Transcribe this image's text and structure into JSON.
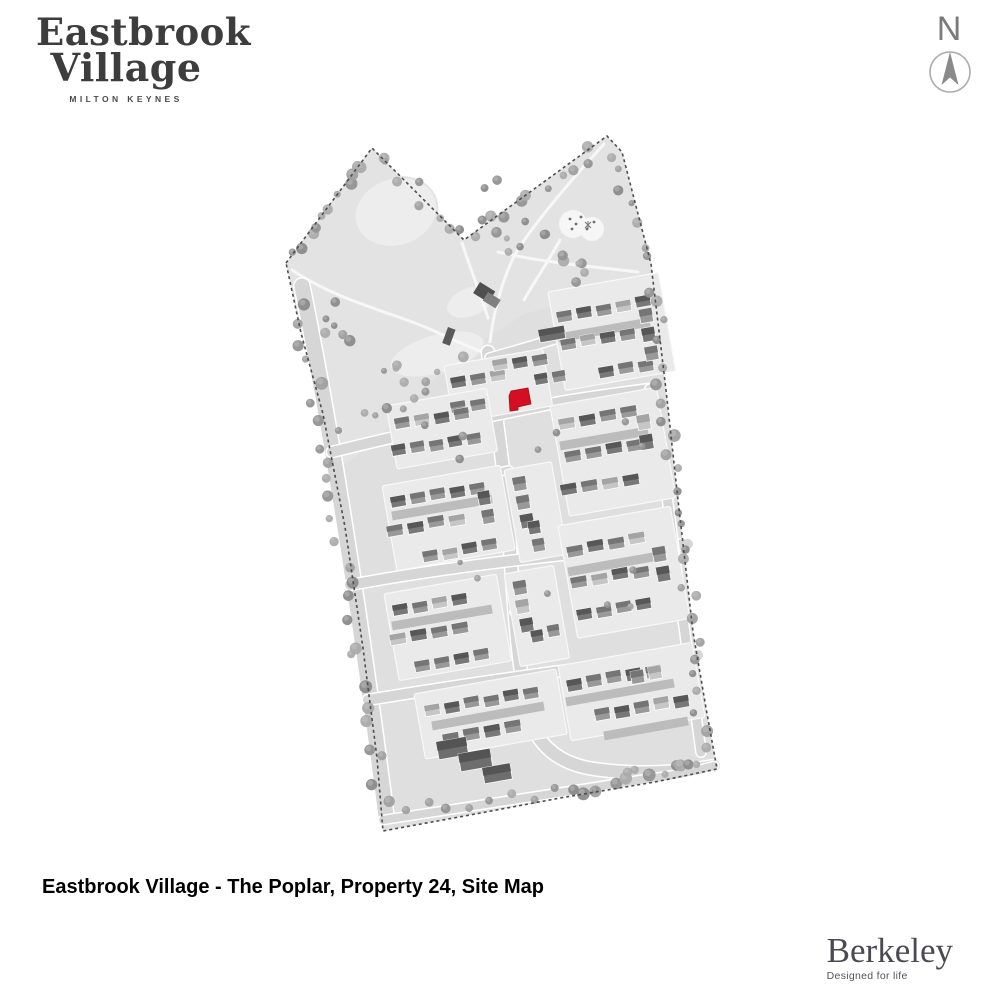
{
  "page": {
    "width": 1000,
    "height": 1000,
    "background": "#ffffff"
  },
  "header": {
    "logo": {
      "line1": "Eastbrook",
      "line2": "Village",
      "subtitle": "MILTON KEYNES",
      "color": "#3d3d3d"
    }
  },
  "compass": {
    "label": "N"
  },
  "caption": {
    "text": "Eastbrook Village - The Poplar, Property 24, Site Map"
  },
  "footer": {
    "brand": "Berkeley",
    "tagline": "Designed for life",
    "color": "#4a4a52"
  },
  "map": {
    "colors": {
      "base": "#dfdfdf",
      "park": "#e3e3e3",
      "pond": "#ededed",
      "pond_edge": "#e3e3e3",
      "path": "#f7f7f7",
      "road": "#d6d6d6",
      "road_casing": "#ffffff",
      "parcel": "#eaeaea",
      "parcel_edge": "#f8f8f8",
      "drive": "#bcbcbc",
      "boundary": "#4d4d4d",
      "highlight": "#d30f23",
      "highlight_edge": "#a50d1a",
      "tree_palette": [
        "#a0a0a0",
        "#949494",
        "#ababab",
        "#8b8b8b"
      ],
      "house": {
        "mid": [
          "#999999",
          "#757575"
        ],
        "dark": [
          "#787878",
          "#575757"
        ],
        "light": [
          "#c6c6c6",
          "#a4a4a4"
        ]
      },
      "apartment": [
        "#6e6e6e",
        "#545454"
      ]
    },
    "boundary": "286,263 372,148 464,240 607,136 622,152 651,264 666,390 678,500 693,632 706,708 717,769 655,782 560,798 470,815 383,831 377,758 363,648 345,527 323,414 301,333",
    "park": "286,263 372,148 464,240 607,136 622,152 651,264 643,300 584,298 524,314 490,336 464,352 434,380 402,414 372,444 338,470 327,436 301,333",
    "ponds": [
      {
        "cx": 396,
        "cy": 212,
        "rx": 42,
        "ry": 34,
        "rot": -18
      },
      {
        "cx": 470,
        "cy": 302,
        "rx": 25,
        "ry": 15,
        "rot": -22
      },
      {
        "cx": 437,
        "cy": 354,
        "rx": 49,
        "ry": 20,
        "rot": -16
      }
    ],
    "paths": [
      "M292,270 C340,302 392,312 432,330 C462,344 476,350 488,354",
      "M604,144 C566,186 544,212 520,246 C506,268 494,306 490,342",
      "M462,243 C470,268 480,292 488,318",
      "M498,252 C540,262 586,266 638,272",
      "M560,240 C548,262 534,282 524,300"
    ],
    "roads": [
      {
        "d": "M302,286 C330,424 360,612 386,816",
        "w": 15
      },
      {
        "d": "M488,352 C496,420 505,472 509,532 C513,594 516,652 527,708 C534,744 558,766 602,770 C642,775 682,772 714,766",
        "w": 12
      },
      {
        "d": "M332,452 C420,430 500,414 560,402 C602,395 628,392 650,389",
        "w": 10
      },
      {
        "d": "M350,585 C430,570 520,559 600,551 C632,548 662,546 688,544",
        "w": 10
      },
      {
        "d": "M368,700 C440,688 520,676 600,666 C642,661 672,658 698,655",
        "w": 10
      },
      {
        "d": "M650,389 C662,450 670,520 678,582 C686,642 694,702 701,752",
        "w": 9
      },
      {
        "d": "M490,358 C540,344 578,332 616,320 C636,314 648,308 650,296",
        "w": 9
      },
      {
        "d": "M383,820 C470,807 560,792 640,780 C672,776 696,771 714,766",
        "w": 8
      },
      {
        "d": "M509,470 L478,476",
        "w": 7
      },
      {
        "d": "M514,612 L556,606",
        "w": 7
      }
    ],
    "driveways": [
      "M558,338 l92,-16",
      "M560,446 l88,-15",
      "M392,516 l100,-17",
      "M568,572 l96,-17",
      "M392,626 l100,-17",
      "M566,702 l108,-19",
      "M432,726 l112,-20",
      "M604,736 l84,-15"
    ],
    "clusters": [
      {
        "parcel": [
          548,
          292,
          112,
          100
        ],
        "rows": [
          {
            "x": 556,
            "y": 312,
            "n": 5
          },
          {
            "x": 560,
            "y": 340,
            "n": 4
          },
          {
            "x": 598,
            "y": 368,
            "n": 3
          },
          {
            "x": 638,
            "y": 310,
            "n": 3,
            "dir": "v",
            "w": 13,
            "h": 14
          }
        ]
      },
      {
        "parcel": [
          444,
          366,
          100,
          58
        ],
        "rows": [
          {
            "x": 450,
            "y": 378,
            "n": 3
          },
          {
            "x": 492,
            "y": 362,
            "n": 3
          },
          {
            "x": 450,
            "y": 404,
            "n": 2
          },
          {
            "x": 534,
            "y": 376,
            "n": 2,
            "w": 13,
            "h": 11
          }
        ]
      },
      {
        "parcel": [
          386,
          406,
          102,
          64
        ],
        "rows": [
          {
            "x": 394,
            "y": 420,
            "n": 4
          },
          {
            "x": 391,
            "y": 447,
            "n": 5,
            "w": 14
          }
        ]
      },
      {
        "parcel": [
          550,
          406,
          108,
          112
        ],
        "rows": [
          {
            "x": 558,
            "y": 420,
            "n": 4,
            "w": 16
          },
          {
            "x": 564,
            "y": 452,
            "n": 4,
            "w": 16
          },
          {
            "x": 560,
            "y": 486,
            "n": 4,
            "w": 16
          },
          {
            "x": 636,
            "y": 416,
            "n": 2,
            "dir": "v",
            "w": 13,
            "h": 15
          }
        ]
      },
      {
        "parcel": [
          382,
          486,
          120,
          86
        ],
        "rows": [
          {
            "x": 390,
            "y": 498,
            "n": 5
          },
          {
            "x": 386,
            "y": 526,
            "n": 4,
            "w": 16
          },
          {
            "x": 422,
            "y": 552,
            "n": 4
          },
          {
            "x": 478,
            "y": 492,
            "n": 2,
            "dir": "v",
            "w": 12,
            "h": 14
          }
        ]
      },
      {
        "parcel": [
          504,
          470,
          48,
          94
        ],
        "rows": [
          {
            "x": 512,
            "y": 478,
            "n": 3,
            "dir": "v",
            "w": 13,
            "h": 14
          },
          {
            "x": 528,
            "y": 522,
            "n": 2,
            "dir": "v",
            "w": 12,
            "h": 13
          }
        ]
      },
      {
        "parcel": [
          558,
          526,
          114,
          114
        ],
        "rows": [
          {
            "x": 566,
            "y": 546,
            "n": 4,
            "w": 16
          },
          {
            "x": 570,
            "y": 578,
            "n": 4,
            "w": 16
          },
          {
            "x": 576,
            "y": 610,
            "n": 4
          },
          {
            "x": 652,
            "y": 548,
            "n": 2,
            "dir": "v",
            "w": 13,
            "h": 15
          }
        ]
      },
      {
        "parcel": [
          384,
          594,
          114,
          88
        ],
        "rows": [
          {
            "x": 392,
            "y": 606,
            "n": 4
          },
          {
            "x": 389,
            "y": 634,
            "n": 4,
            "w": 16
          },
          {
            "x": 414,
            "y": 662,
            "n": 4
          }
        ]
      },
      {
        "parcel": [
          504,
          574,
          50,
          94
        ],
        "rows": [
          {
            "x": 512,
            "y": 582,
            "n": 3,
            "dir": "v",
            "w": 13,
            "h": 14
          },
          {
            "x": 530,
            "y": 630,
            "n": 2,
            "w": 12,
            "h": 12
          }
        ]
      },
      {
        "parcel": [
          414,
          694,
          144,
          66
        ],
        "rows": [
          {
            "x": 424,
            "y": 706,
            "n": 6
          },
          {
            "x": 442,
            "y": 734,
            "n": 4,
            "w": 16,
            "h": 12
          }
        ]
      },
      {
        "parcel": [
          558,
          666,
          136,
          76
        ],
        "rows": [
          {
            "x": 566,
            "y": 680,
            "n": 5,
            "h": 12
          },
          {
            "x": 594,
            "y": 710,
            "n": 5,
            "h": 12
          },
          {
            "x": 630,
            "y": 672,
            "n": 2,
            "w": 13,
            "h": 13
          }
        ]
      }
    ],
    "apartment_blocks": [
      [
        436,
        742,
        30,
        18
      ],
      [
        458,
        754,
        32,
        18
      ],
      [
        482,
        768,
        28,
        16
      ],
      [
        538,
        330,
        26,
        13
      ]
    ],
    "marketing_suite": [
      [
        480,
        282,
        18,
        13,
        32,
        "#4f4f4f"
      ],
      [
        488,
        292,
        15,
        10,
        32,
        "#7f7f7f"
      ]
    ],
    "bridge": [
      448,
      327,
      8,
      17,
      20,
      "#5a5a5a"
    ],
    "playground": {
      "blobs": [
        [
          573,
          224,
          14
        ],
        [
          592,
          229,
          12
        ]
      ],
      "dots": [
        [
          570,
          219
        ],
        [
          576,
          224
        ],
        [
          572,
          229
        ],
        [
          581,
          217
        ],
        [
          587,
          229
        ],
        [
          594,
          222
        ]
      ],
      "star": [
        588,
        225
      ]
    },
    "highlight": {
      "points": "509,396 511,391 528,388 531,404 518,407 518,410 510,411",
      "label": "Property 24"
    },
    "tree_corridors": [
      {
        "a": [
          298,
          292
        ],
        "b": [
          384,
          812
        ],
        "n": 26,
        "j": 9,
        "r": [
          3.5,
          6.5
        ]
      },
      {
        "a": [
          292,
          262
        ],
        "b": [
          370,
          156
        ],
        "n": 11,
        "j": 7,
        "r": [
          3.5,
          6.5
        ]
      },
      {
        "a": [
          374,
          152
        ],
        "b": [
          460,
          238
        ],
        "n": 8,
        "j": 8,
        "r": [
          3,
          6
        ]
      },
      {
        "a": [
          468,
          238
        ],
        "b": [
          602,
          142
        ],
        "n": 10,
        "j": 9,
        "r": [
          3,
          6
        ]
      },
      {
        "a": [
          610,
          150
        ],
        "b": [
          648,
          268
        ],
        "n": 7,
        "j": 7,
        "r": [
          3,
          5.5
        ]
      },
      {
        "a": [
          652,
          280
        ],
        "b": [
          706,
          756
        ],
        "n": 26,
        "j": 8,
        "r": [
          3.5,
          6.5
        ]
      },
      {
        "a": [
          396,
          812
        ],
        "b": [
          560,
          792
        ],
        "n": 8,
        "j": 6,
        "r": [
          3,
          5
        ]
      },
      {
        "a": [
          566,
          790
        ],
        "b": [
          706,
          762
        ],
        "n": 14,
        "j": 7,
        "r": [
          3.5,
          6.5
        ]
      },
      {
        "a": [
          318,
          300
        ],
        "b": [
          420,
          420
        ],
        "n": 12,
        "j": 22,
        "r": [
          3,
          6
        ]
      },
      {
        "a": [
          470,
          180
        ],
        "b": [
          600,
          300
        ],
        "n": 16,
        "j": 26,
        "r": [
          3,
          6
        ]
      },
      {
        "a": [
          340,
          430
        ],
        "b": [
          470,
          350
        ],
        "n": 9,
        "j": 12,
        "r": [
          3,
          5.5
        ]
      },
      {
        "a": [
          430,
          460
        ],
        "b": [
          660,
          430
        ],
        "n": 6,
        "j": 30,
        "r": [
          2.5,
          4.5
        ]
      },
      {
        "a": [
          420,
          600
        ],
        "b": [
          680,
          580
        ],
        "n": 6,
        "j": 36,
        "r": [
          2.5,
          4.5
        ]
      }
    ]
  }
}
